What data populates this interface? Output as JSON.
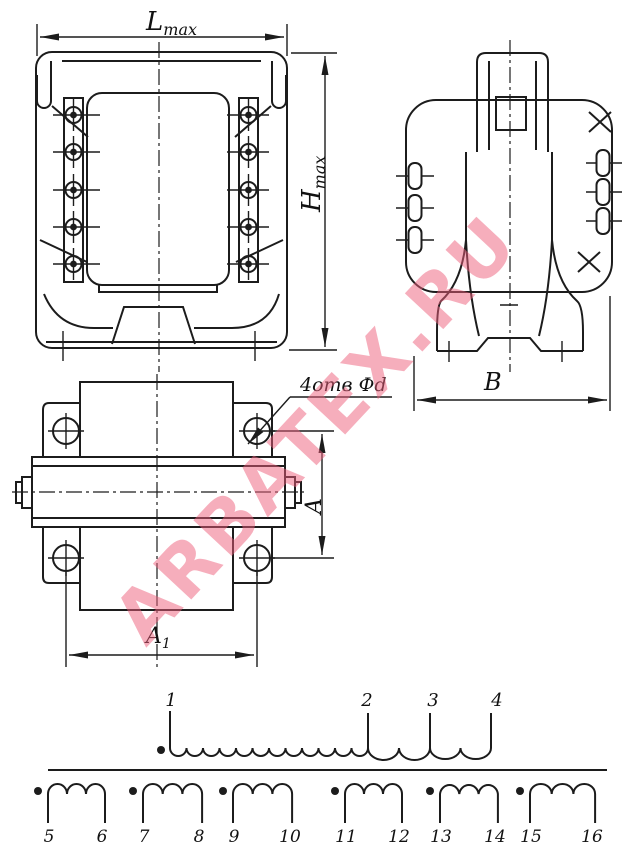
{
  "drawing": {
    "type": "transformer dimensional drawing with winding schematic",
    "ink_color": "#1c1c1c",
    "dimensions": {
      "lmax": {
        "main": "L",
        "sub": "max"
      },
      "hmax": {
        "main": "H",
        "sub": "max"
      },
      "depth": "B",
      "a": "A",
      "a1": {
        "main": "A",
        "sub": "1"
      },
      "holes_note": "4отв Фd"
    }
  },
  "schematic": {
    "primary_terminals": [
      "1",
      "2",
      "3",
      "4"
    ],
    "secondary_windings": [
      {
        "start": "5",
        "end": "6"
      },
      {
        "start": "7",
        "end": "8"
      },
      {
        "start": "9",
        "end": "10"
      },
      {
        "start": "11",
        "end": "12"
      },
      {
        "start": "13",
        "end": "14"
      },
      {
        "start": "15",
        "end": "16"
      }
    ]
  },
  "watermark": {
    "text": "ARBATEX.RU",
    "color": "#ee5f7c"
  }
}
